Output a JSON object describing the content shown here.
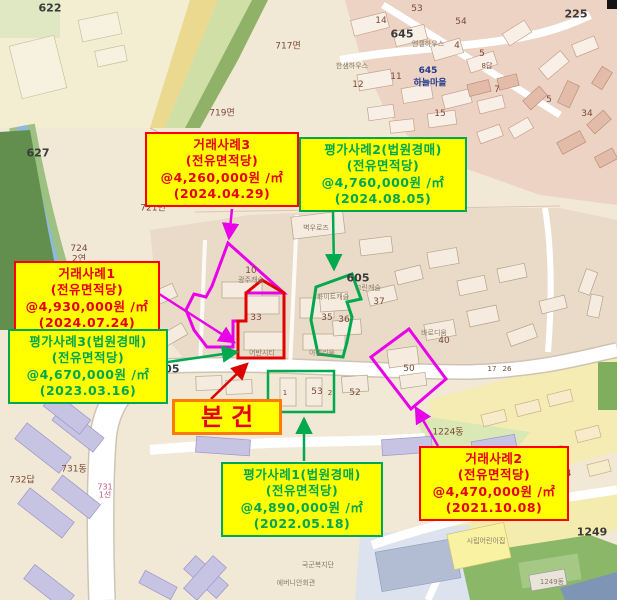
{
  "title": "감정평가 사례 위치도",
  "colors": {
    "callout_bg": "#ffff00",
    "sale_accent": "#e60012",
    "appraisal_accent": "#00a650",
    "subject_border": "#ff7a00",
    "magenta_outline": "#e800e8",
    "red_outline": "#e00000",
    "green_outline": "#00a84e"
  },
  "callouts": {
    "sale3": {
      "title": "거래사례3",
      "line2": "(전유면적당)",
      "line3": "@4,260,000원 /㎡",
      "line4": "(2024.04.29)"
    },
    "app2": {
      "title": "평가사례2(법원경매)",
      "line2": "(전유면적당)",
      "line3": "@4,760,000원 /㎡",
      "line4": "(2024.08.05)"
    },
    "sale1": {
      "title": "거래사례1",
      "line2": "(전유면적당)",
      "line3": "@4,930,000원 /㎡",
      "line4": "(2024.07.24)"
    },
    "app3": {
      "title": "평가사례3(법원경매)",
      "line2": "(전유면적당)",
      "line3": "@4,670,000원 /㎡",
      "line4": "(2023.03.16)"
    },
    "app1": {
      "title": "평가사례1(법원경매)",
      "line2": "(전유면적당)",
      "line3": "@4,890,000원 /㎡",
      "line4": "(2022.05.18)"
    },
    "sale2": {
      "title": "거래사례2",
      "line2": "(전유면적당)",
      "line3": "@4,470,000원 /㎡",
      "line4": "(2021.10.08)"
    },
    "subject": {
      "label": "본건"
    }
  },
  "map": {
    "labels": [
      {
        "text": "622",
        "x": 50,
        "y": 8,
        "cls": "big"
      },
      {
        "text": "717면",
        "x": 288,
        "y": 45,
        "cls": "num"
      },
      {
        "text": "719면",
        "x": 222,
        "y": 112,
        "cls": "num"
      },
      {
        "text": "721면",
        "x": 153,
        "y": 207,
        "cls": "num"
      },
      {
        "text": "627",
        "x": 38,
        "y": 153,
        "cls": "big"
      },
      {
        "text": "724",
        "x": 79,
        "y": 249,
        "cls": "num"
      },
      {
        "text": "2연",
        "x": 79,
        "y": 258,
        "cls": "num"
      },
      {
        "text": "225",
        "x": 576,
        "y": 14,
        "cls": "big"
      },
      {
        "text": "645",
        "x": 402,
        "y": 34,
        "cls": "big"
      },
      {
        "text": "14",
        "x": 381,
        "y": 21,
        "cls": "num"
      },
      {
        "text": "645",
        "x": 428,
        "y": 71,
        "cls": "navy"
      },
      {
        "text": "하늘마을",
        "x": 430,
        "y": 82,
        "cls": "navy"
      },
      {
        "text": "한샘하우스",
        "x": 352,
        "y": 66,
        "cls": "bname"
      },
      {
        "text": "엔젤하우스",
        "x": 428,
        "y": 44,
        "cls": "bname"
      },
      {
        "text": "53",
        "x": 417,
        "y": 9,
        "cls": "num"
      },
      {
        "text": "54",
        "x": 461,
        "y": 22,
        "cls": "num"
      },
      {
        "text": "4",
        "x": 457,
        "y": 46,
        "cls": "num"
      },
      {
        "text": "5",
        "x": 482,
        "y": 54,
        "cls": "num"
      },
      {
        "text": "5",
        "x": 549,
        "y": 100,
        "cls": "num"
      },
      {
        "text": "7",
        "x": 497,
        "y": 90,
        "cls": "num"
      },
      {
        "text": "8답",
        "x": 487,
        "y": 66,
        "cls": "tiny"
      },
      {
        "text": "11",
        "x": 396,
        "y": 77,
        "cls": "num"
      },
      {
        "text": "12",
        "x": 358,
        "y": 85,
        "cls": "num"
      },
      {
        "text": "15",
        "x": 440,
        "y": 114,
        "cls": "num"
      },
      {
        "text": "34",
        "x": 587,
        "y": 114,
        "cls": "num"
      },
      {
        "text": "10",
        "x": 251,
        "y": 271,
        "cls": "num"
      },
      {
        "text": "33",
        "x": 256,
        "y": 318,
        "cls": "num"
      },
      {
        "text": "35",
        "x": 327,
        "y": 318,
        "cls": "num"
      },
      {
        "text": "36",
        "x": 344,
        "y": 320,
        "cls": "num"
      },
      {
        "text": "37",
        "x": 379,
        "y": 302,
        "cls": "num"
      },
      {
        "text": "40",
        "x": 444,
        "y": 341,
        "cls": "num"
      },
      {
        "text": "50",
        "x": 409,
        "y": 369,
        "cls": "num"
      },
      {
        "text": "53",
        "x": 317,
        "y": 392,
        "cls": "num"
      },
      {
        "text": "52",
        "x": 355,
        "y": 393,
        "cls": "num"
      },
      {
        "text": "1",
        "x": 285,
        "y": 393,
        "cls": "tiny"
      },
      {
        "text": "2",
        "x": 330,
        "y": 393,
        "cls": "tiny"
      },
      {
        "text": "605",
        "x": 358,
        "y": 278,
        "cls": "big"
      },
      {
        "text": "그린캐슬",
        "x": 368,
        "y": 288,
        "cls": "bname"
      },
      {
        "text": "605",
        "x": 168,
        "y": 369,
        "cls": "big"
      },
      {
        "text": "731동",
        "x": 74,
        "y": 468,
        "cls": "num"
      },
      {
        "text": "732답",
        "x": 22,
        "y": 479,
        "cls": "num"
      },
      {
        "text": "731",
        "x": 105,
        "y": 487,
        "cls": "pink"
      },
      {
        "text": "1선",
        "x": 105,
        "y": 495,
        "cls": "pink"
      },
      {
        "text": "1234",
        "x": 560,
        "y": 474,
        "cls": "num"
      },
      {
        "text": "1224동",
        "x": 448,
        "y": 431,
        "cls": "num"
      },
      {
        "text": "17",
        "x": 492,
        "y": 369,
        "cls": "tiny"
      },
      {
        "text": "26",
        "x": 507,
        "y": 369,
        "cls": "tiny"
      },
      {
        "text": "광주캐슬",
        "x": 251,
        "y": 280,
        "cls": "bname"
      },
      {
        "text": "화이트캐슬",
        "x": 333,
        "y": 297,
        "cls": "bname"
      },
      {
        "text": "아델리움",
        "x": 322,
        "y": 353,
        "cls": "bname"
      },
      {
        "text": "어반시티",
        "x": 262,
        "y": 353,
        "cls": "bname"
      },
      {
        "text": "벽우로즈",
        "x": 316,
        "y": 228,
        "cls": "bname"
      },
      {
        "text": "바로디움",
        "x": 434,
        "y": 333,
        "cls": "bname"
      },
      {
        "text": "문흥신급교회",
        "x": 497,
        "y": 450,
        "cls": "bname"
      },
      {
        "text": "시립어린이집",
        "x": 486,
        "y": 541,
        "cls": "bname"
      },
      {
        "text": "에버니안회관",
        "x": 296,
        "y": 583,
        "cls": "bname"
      },
      {
        "text": "국군복지단",
        "x": 318,
        "y": 565,
        "cls": "bname"
      },
      {
        "text": "1249",
        "x": 592,
        "y": 532,
        "cls": "big"
      },
      {
        "text": "1249동",
        "x": 552,
        "y": 582,
        "cls": "bname"
      }
    ]
  }
}
